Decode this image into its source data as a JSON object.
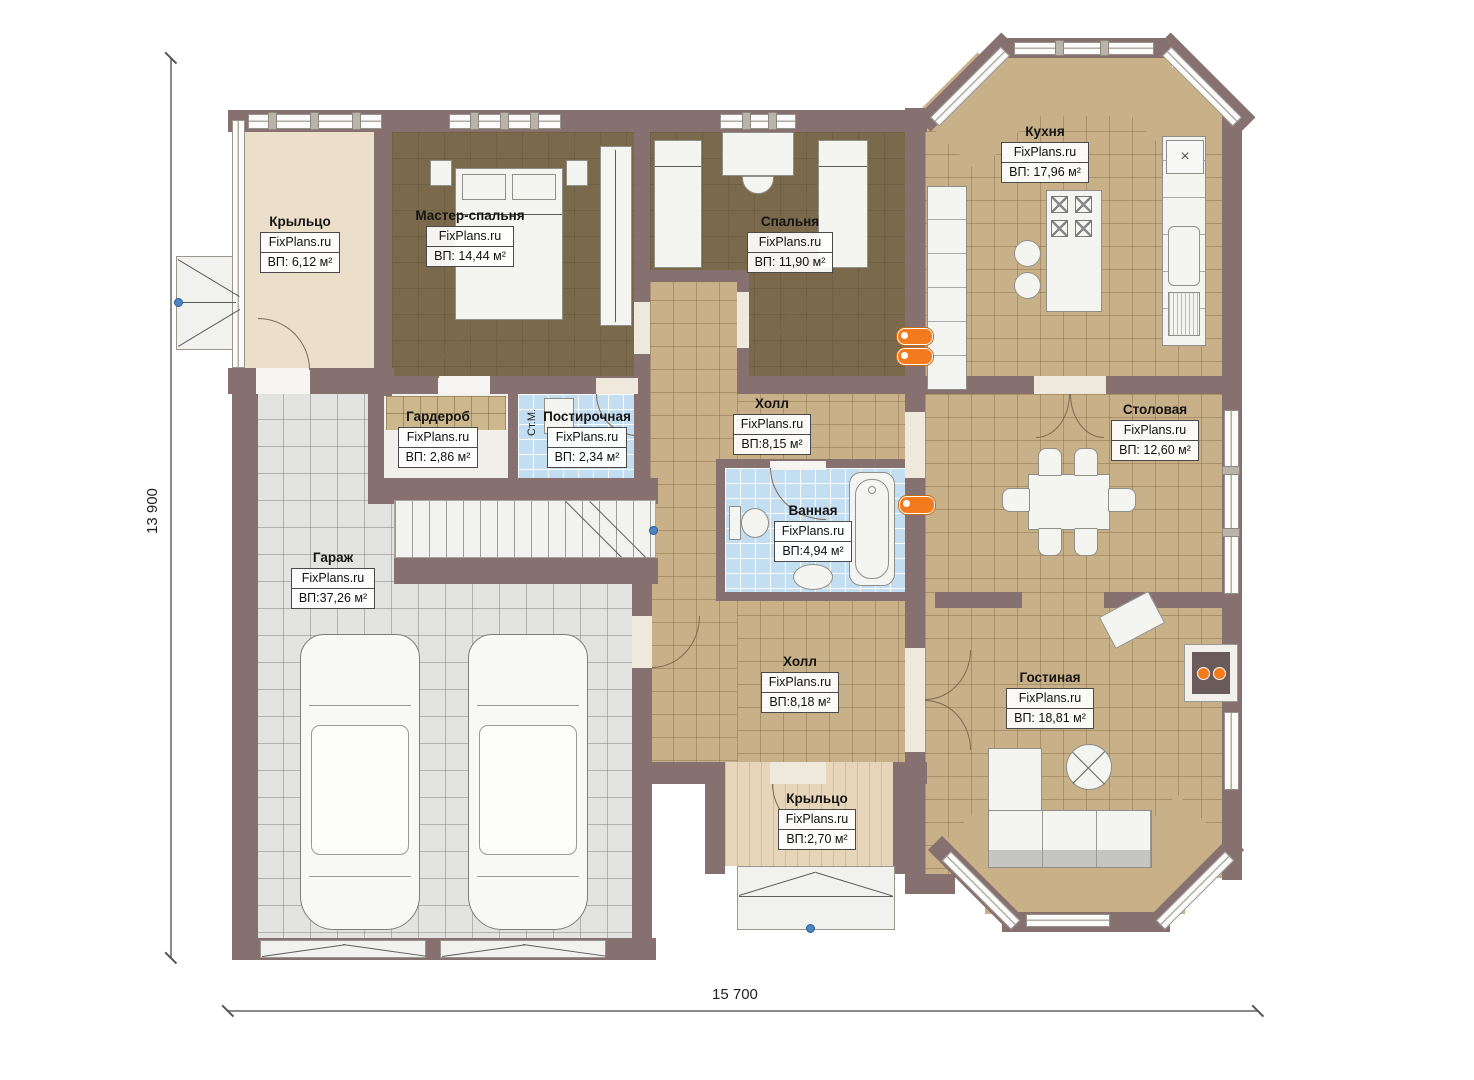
{
  "plan": {
    "watermark": "FixPlans.ru",
    "dimensions": {
      "height": "13 900",
      "width": "15 700"
    },
    "annotations": {
      "washing_machine": "Ст.М.",
      "kitchen_item": "×"
    },
    "rooms": {
      "porch_left": {
        "name": "Крыльцо",
        "area": "ВП: 6,12 м²"
      },
      "master_bedroom": {
        "name": "Мастер-спальня",
        "area": "ВП: 14,44 м²"
      },
      "bedroom": {
        "name": "Спальня",
        "area": "ВП: 11,90 м²"
      },
      "kitchen": {
        "name": "Кухня",
        "area": "ВП: 17,96 м²"
      },
      "wardrobe": {
        "name": "Гардероб",
        "area": "ВП: 2,86 м²"
      },
      "laundry": {
        "name": "Постирочная",
        "area": "ВП: 2,34 м²"
      },
      "hall_upper": {
        "name": "Холл",
        "area": "ВП:8,15 м²"
      },
      "bathroom": {
        "name": "Ванная",
        "area": "ВП:4,94 м²"
      },
      "dining": {
        "name": "Столовая",
        "area": "ВП: 12,60 м²"
      },
      "garage": {
        "name": "Гараж",
        "area": "ВП:37,26 м²"
      },
      "hall_lower": {
        "name": "Холл",
        "area": "ВП:8,18 м²"
      },
      "living": {
        "name": "Гостиная",
        "area": "ВП: 18,81 м²"
      },
      "porch_bottom": {
        "name": "Крыльцо",
        "area": "ВП:2,70 м²"
      }
    },
    "colors": {
      "wall": "#867070",
      "floor_tan": "#c8b088",
      "floor_brown": "#7a694b",
      "floor_blue": "#c3ddf1",
      "floor_gray": "#e3e3e1",
      "floor_cream": "#ebdfca",
      "accent_orange": "#f37b1e",
      "marker_blue": "#4d86c4"
    }
  }
}
